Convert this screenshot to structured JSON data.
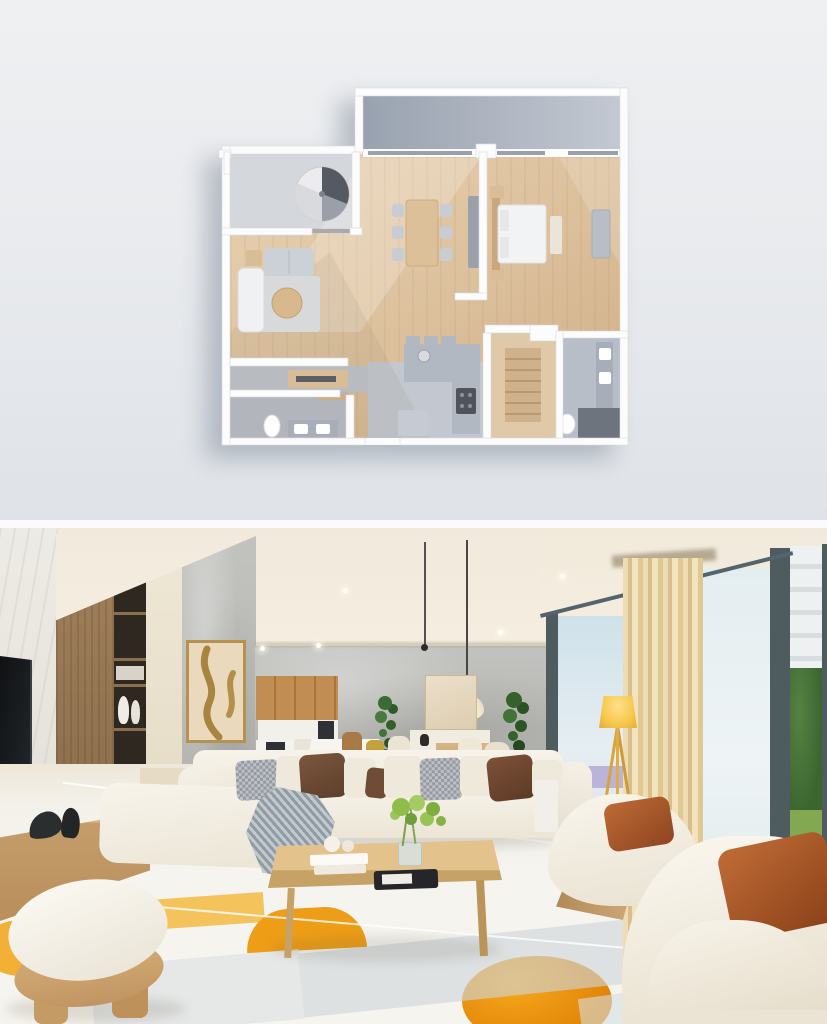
{
  "panels": {
    "top": {
      "kind": "3d-floor-plan-render",
      "background": "light-gray-studio"
    },
    "bottom": {
      "kind": "photorealistic-living-room-render"
    }
  },
  "palette": {
    "plan_wall": "#fcfcfd",
    "plan_wood": "#ddc3a0",
    "plan_gray_floor": "#bfc4cc",
    "plan_bath_floor": "#b8bec8",
    "plan_stair_floor": "#d4d7db",
    "plan_counter": "#b2b8c2",
    "plan_dark_fixture": "#4f545c",
    "plan_sofa_gray": "#ccd1d8",
    "plan_chaise_white": "#f0f1f2",
    "plan_table_wood": "#d7b98d",
    "plan_bed_white": "#f2f3f4",
    "plan_wood_accent": "#d8bd96",
    "ceiling": "#f4ede0",
    "concrete": "#bcbdb9",
    "marble_wall": "#eae8e2",
    "shelf_wood": "#9a7a55",
    "shelf_dark": "#2f2821",
    "art_canvas": "#ead9bd",
    "art_gold": "#a8853e",
    "cabinet_wood": "#bd8850",
    "counter_white": "#f5f3ed",
    "appliance_dark": "#2e3236",
    "plant_green": "#3c6b34",
    "pendant_white": "#f6efdf",
    "window_frame": "#50606496",
    "mullion_dark": "#4e5c60",
    "sky_glass": "#d3e4ec",
    "haze_glass": "#e6eef0",
    "building_white": "#eef1f1",
    "tree_green": "#46703a",
    "grass_green": "#82a851",
    "pool_violet": "#b9b4d8",
    "curtain_beige": "#e9d6ab",
    "lamp_yellow": "#f6c84d",
    "lamp_leg": "#d9a43c",
    "sofa_white": "#f4efe5",
    "pillow_gray": "#959aa2",
    "pillow_brown": "#6b4a34",
    "pillow_cream": "#efe9dc",
    "pillow_rust": "#b05c2c",
    "throw_gray": "#a3adb5",
    "coffee_table_wood": "#d9b67e",
    "tray_black": "#26262a",
    "flower_green": "#8fbd4a",
    "floor_white": "#f3f1ec",
    "tile_blue_gray": "#cdd5da",
    "tile_orange": "#ef9a11",
    "tile_amber": "#f5c35c",
    "base_wood": "#c9a26b"
  },
  "floorplan": {
    "rooms": [
      "balcony",
      "staircase-room",
      "living-room",
      "dining-area",
      "bedroom",
      "corridor",
      "bathroom",
      "kitchen",
      "hallway",
      "second-bathroom"
    ],
    "furniture": [
      "spiral-staircase",
      "sofa",
      "chaise-longue",
      "round-coffee-table",
      "rug",
      "dining-table",
      "six-dining-chairs",
      "tv-sideboard",
      "double-bed",
      "nightstands",
      "bench",
      "dresser",
      "kitchen-counter",
      "cooktop",
      "console-table",
      "toilet",
      "double-sink-vanity",
      "second-toilet",
      "second-vanity"
    ]
  },
  "interior": {
    "objects": [
      "wall-tv",
      "media-console",
      "decor-sculptures",
      "wood-shelf-tower",
      "vases-and-books",
      "abstract-art-frame",
      "concrete-wall",
      "kitchen-cabinets",
      "kitchen-island",
      "coffee-machine",
      "oven",
      "pendant-lamp",
      "indoor-plants",
      "sideboard",
      "dining-table-and-chairs",
      "art-panel",
      "floor-to-ceiling-windows",
      "beige-curtain",
      "yellow-tripod-floor-lamp",
      "white-sectional-sofa",
      "throw-blanket",
      "accent-pillows",
      "wood-coffee-table",
      "books-and-tray",
      "flower-vase",
      "two-white-armchairs",
      "rust-velvet-pillows",
      "white-wood-ottoman",
      "geometric-tile-floor",
      "outside-building-and-garden"
    ]
  }
}
